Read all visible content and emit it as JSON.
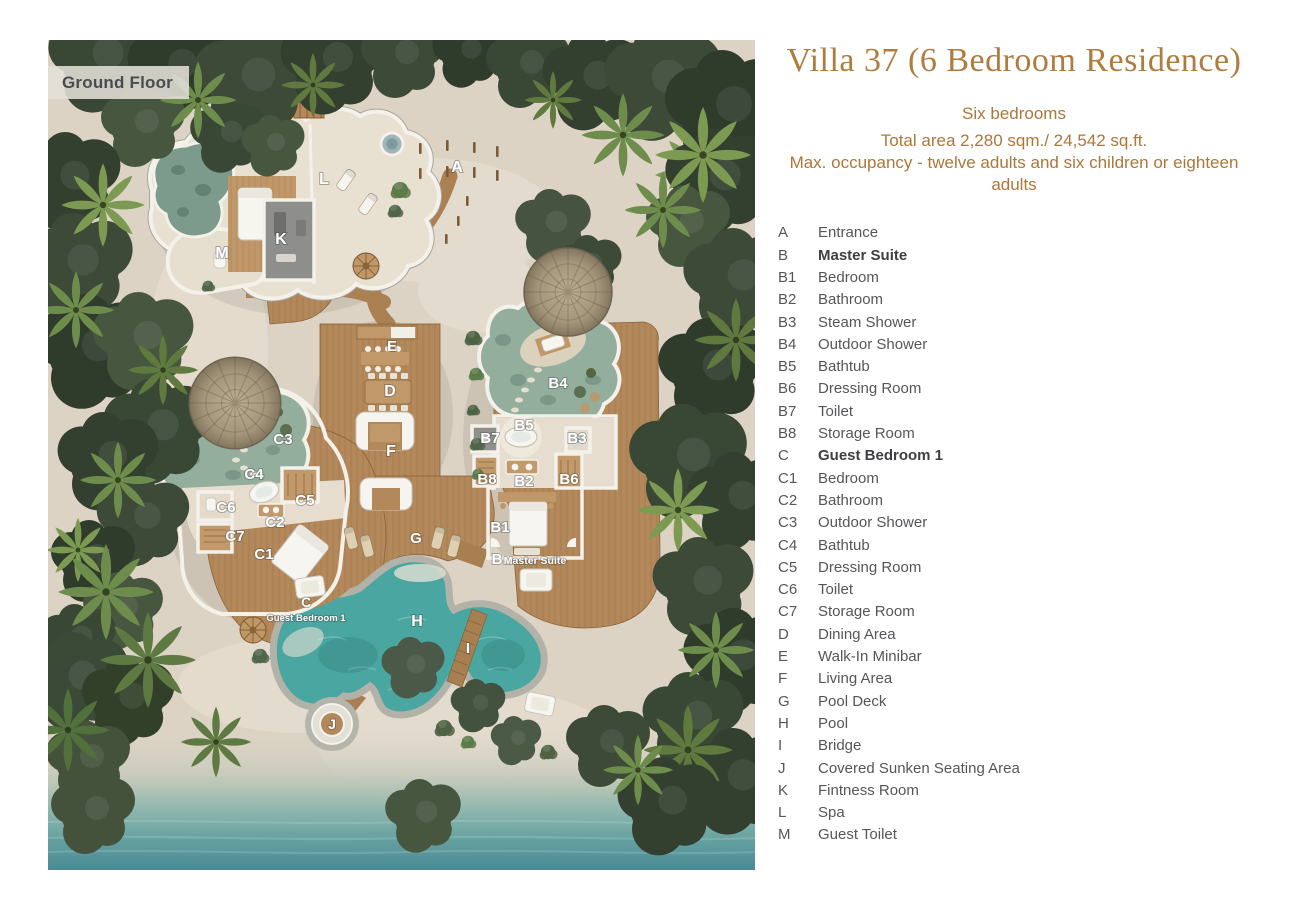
{
  "header": {
    "title": "Villa 37 (6 Bedroom Residence)",
    "subtitle_lines": [
      "Six bedrooms",
      "Total area 2,280 sqm./ 24,542 sq.ft.",
      "Max. occupancy - twelve adults and six children or eighteen adults"
    ]
  },
  "plan": {
    "floor_label": "Ground Floor",
    "labels": [
      {
        "id": "A",
        "text": "A",
        "x": 409,
        "y": 132,
        "size": 16
      },
      {
        "id": "L",
        "text": "L",
        "x": 276,
        "y": 144,
        "size": 16
      },
      {
        "id": "K",
        "text": "K",
        "x": 233,
        "y": 204,
        "size": 16
      },
      {
        "id": "M",
        "text": "M",
        "x": 174,
        "y": 218,
        "size": 16
      },
      {
        "id": "E",
        "text": "E",
        "x": 344,
        "y": 311,
        "size": 15
      },
      {
        "id": "D",
        "text": "D",
        "x": 342,
        "y": 356,
        "size": 16
      },
      {
        "id": "F",
        "text": "F",
        "x": 343,
        "y": 416,
        "size": 16
      },
      {
        "id": "B4",
        "text": "B4",
        "x": 510,
        "y": 348,
        "size": 15
      },
      {
        "id": "B5",
        "text": "B5",
        "x": 476,
        "y": 390,
        "size": 15
      },
      {
        "id": "B7",
        "text": "B7",
        "x": 442,
        "y": 403,
        "size": 15
      },
      {
        "id": "B3",
        "text": "B3",
        "x": 529,
        "y": 403,
        "size": 15
      },
      {
        "id": "B8",
        "text": "B8",
        "x": 439,
        "y": 444,
        "size": 15
      },
      {
        "id": "B2",
        "text": "B2",
        "x": 476,
        "y": 446,
        "size": 15
      },
      {
        "id": "B6",
        "text": "B6",
        "x": 521,
        "y": 444,
        "size": 15
      },
      {
        "id": "B1",
        "text": "B1",
        "x": 452,
        "y": 492,
        "size": 15
      },
      {
        "id": "B",
        "text": "B",
        "x": 449,
        "y": 524,
        "size": 15
      },
      {
        "id": "B-sub",
        "text": "Master Suite",
        "x": 487,
        "y": 524,
        "size": 10.5
      },
      {
        "id": "C3",
        "text": "C3",
        "x": 235,
        "y": 404,
        "size": 15
      },
      {
        "id": "C4",
        "text": "C4",
        "x": 206,
        "y": 439,
        "size": 15
      },
      {
        "id": "C5",
        "text": "C5",
        "x": 257,
        "y": 465,
        "size": 15
      },
      {
        "id": "C6",
        "text": "C6",
        "x": 178,
        "y": 472,
        "size": 15
      },
      {
        "id": "C2",
        "text": "C2",
        "x": 227,
        "y": 487,
        "size": 15
      },
      {
        "id": "C7",
        "text": "C7",
        "x": 187,
        "y": 501,
        "size": 15
      },
      {
        "id": "C1",
        "text": "C1",
        "x": 216,
        "y": 519,
        "size": 15
      },
      {
        "id": "C",
        "text": "C",
        "x": 258,
        "y": 567,
        "size": 14
      },
      {
        "id": "C-sub",
        "text": "Guest Bedroom 1",
        "x": 258,
        "y": 581,
        "size": 9.5
      },
      {
        "id": "G",
        "text": "G",
        "x": 368,
        "y": 503,
        "size": 15
      },
      {
        "id": "H",
        "text": "H",
        "x": 369,
        "y": 586,
        "size": 16
      },
      {
        "id": "I",
        "text": "I",
        "x": 420,
        "y": 613,
        "size": 15
      },
      {
        "id": "J",
        "text": "J",
        "x": 284,
        "y": 689,
        "size": 14
      }
    ]
  },
  "legend": {
    "items": [
      {
        "key": "A",
        "label": "Entrance",
        "bold": false
      },
      {
        "key": "B",
        "label": "Master Suite",
        "bold": true
      },
      {
        "key": "B1",
        "label": "Bedroom",
        "bold": false
      },
      {
        "key": "B2",
        "label": "Bathroom",
        "bold": false
      },
      {
        "key": "B3",
        "label": "Steam Shower",
        "bold": false
      },
      {
        "key": "B4",
        "label": "Outdoor Shower",
        "bold": false
      },
      {
        "key": "B5",
        "label": "Bathtub",
        "bold": false
      },
      {
        "key": "B6",
        "label": "Dressing Room",
        "bold": false
      },
      {
        "key": "B7",
        "label": "Toilet",
        "bold": false
      },
      {
        "key": "B8",
        "label": "Storage Room",
        "bold": false
      },
      {
        "key": "C",
        "label": "Guest Bedroom 1",
        "bold": true
      },
      {
        "key": "C1",
        "label": "Bedroom",
        "bold": false
      },
      {
        "key": "C2",
        "label": "Bathroom",
        "bold": false
      },
      {
        "key": "C3",
        "label": "Outdoor Shower",
        "bold": false
      },
      {
        "key": "C4",
        "label": "Bathtub",
        "bold": false
      },
      {
        "key": "C5",
        "label": "Dressing Room",
        "bold": false
      },
      {
        "key": "C6",
        "label": "Toilet",
        "bold": false
      },
      {
        "key": "C7",
        "label": "Storage Room",
        "bold": false
      },
      {
        "key": "D",
        "label": "Dining Area",
        "bold": false
      },
      {
        "key": "E",
        "label": "Walk-In Minibar",
        "bold": false
      },
      {
        "key": "F",
        "label": "Living Area",
        "bold": false
      },
      {
        "key": "G",
        "label": "Pool Deck",
        "bold": false
      },
      {
        "key": "H",
        "label": "Pool",
        "bold": false
      },
      {
        "key": "I",
        "label": "Bridge",
        "bold": false
      },
      {
        "key": "J",
        "label": "Covered Sunken Seating Area",
        "bold": false
      },
      {
        "key": "K",
        "label": "Fintness Room",
        "bold": false
      },
      {
        "key": "L",
        "label": "Spa",
        "bold": false
      },
      {
        "key": "M",
        "label": "Guest Toilet",
        "bold": false
      }
    ]
  },
  "colors": {
    "accent": "#b07c3e",
    "subtitle": "#ae7638",
    "legend-text": "#55565a",
    "legend-bold": "#3e3f43",
    "sand": "#dcd3c4",
    "wood": "#b3885a",
    "wall": "#f3f1ea",
    "pool": "#4aa6a1"
  }
}
